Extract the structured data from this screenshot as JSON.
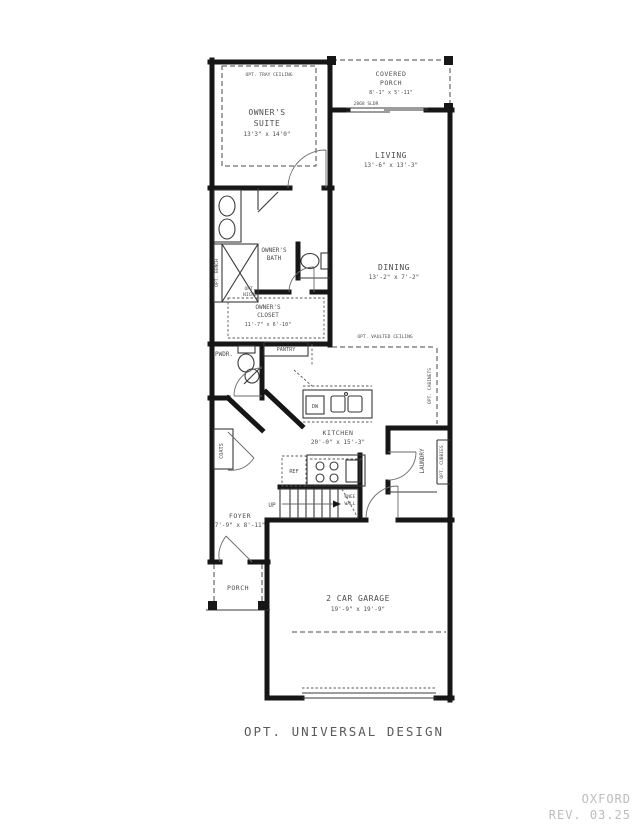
{
  "plan": {
    "rooms": {
      "owners_suite": {
        "line1": "OWNER'S",
        "line2": "SUITE",
        "dims": "13'3\" x 14'0\""
      },
      "covered_porch": {
        "line1": "COVERED",
        "line2": "PORCH",
        "dims": "8'-1\" x 5'-11\""
      },
      "living": {
        "name": "LIVING",
        "dims": "13'-6\" x 13'-3\""
      },
      "dining": {
        "name": "DINING",
        "dims": "13'-2\" x 7'-2\""
      },
      "owners_bath": {
        "line1": "OWNER'S",
        "line2": "BATH"
      },
      "owners_closet": {
        "line1": "OWNER'S",
        "line2": "CLOSET",
        "dims": "11'-7\" x 6'-10\""
      },
      "kitchen": {
        "name": "KITCHEN",
        "dims": "20'-0\" x 15'-3\""
      },
      "foyer": {
        "name": "FOYER",
        "dims": "7'-9\" x 8'-11\""
      },
      "garage": {
        "name": "2 CAR GARAGE",
        "dims": "19'-9\" x 19'-9\""
      },
      "porch": {
        "name": "PORCH"
      },
      "powder": {
        "name": "PWDR."
      },
      "pantry": {
        "name": "PANTRY"
      },
      "laundry": {
        "name": "LAUNDRY"
      },
      "coats": {
        "name": "COATS"
      }
    },
    "notes": {
      "tray_ceiling": "OPT. TRAY CEILING",
      "vaulted_ceiling": "OPT. VAULTED CEILING",
      "bench": "OPT. BENCH",
      "niche_line1": "OPT.",
      "niche_line2": "NICHE",
      "cabinets": "OPT. CABINETS",
      "cubbies": "OPT. CUBBIES",
      "knee_line1": "KNEE",
      "knee_line2": "WALL",
      "slider_door": "2868 SLDR",
      "up": "UP",
      "ref": "REF",
      "dw": "DW"
    },
    "caption": "OPT. UNIVERSAL DESIGN",
    "watermark": {
      "name": "OXFORD",
      "rev": "REV. 03.25"
    }
  },
  "colors": {
    "wall": "#161616",
    "label": "#4d4d4d",
    "watermark": "#bcbcbc",
    "background": "#ffffff"
  }
}
